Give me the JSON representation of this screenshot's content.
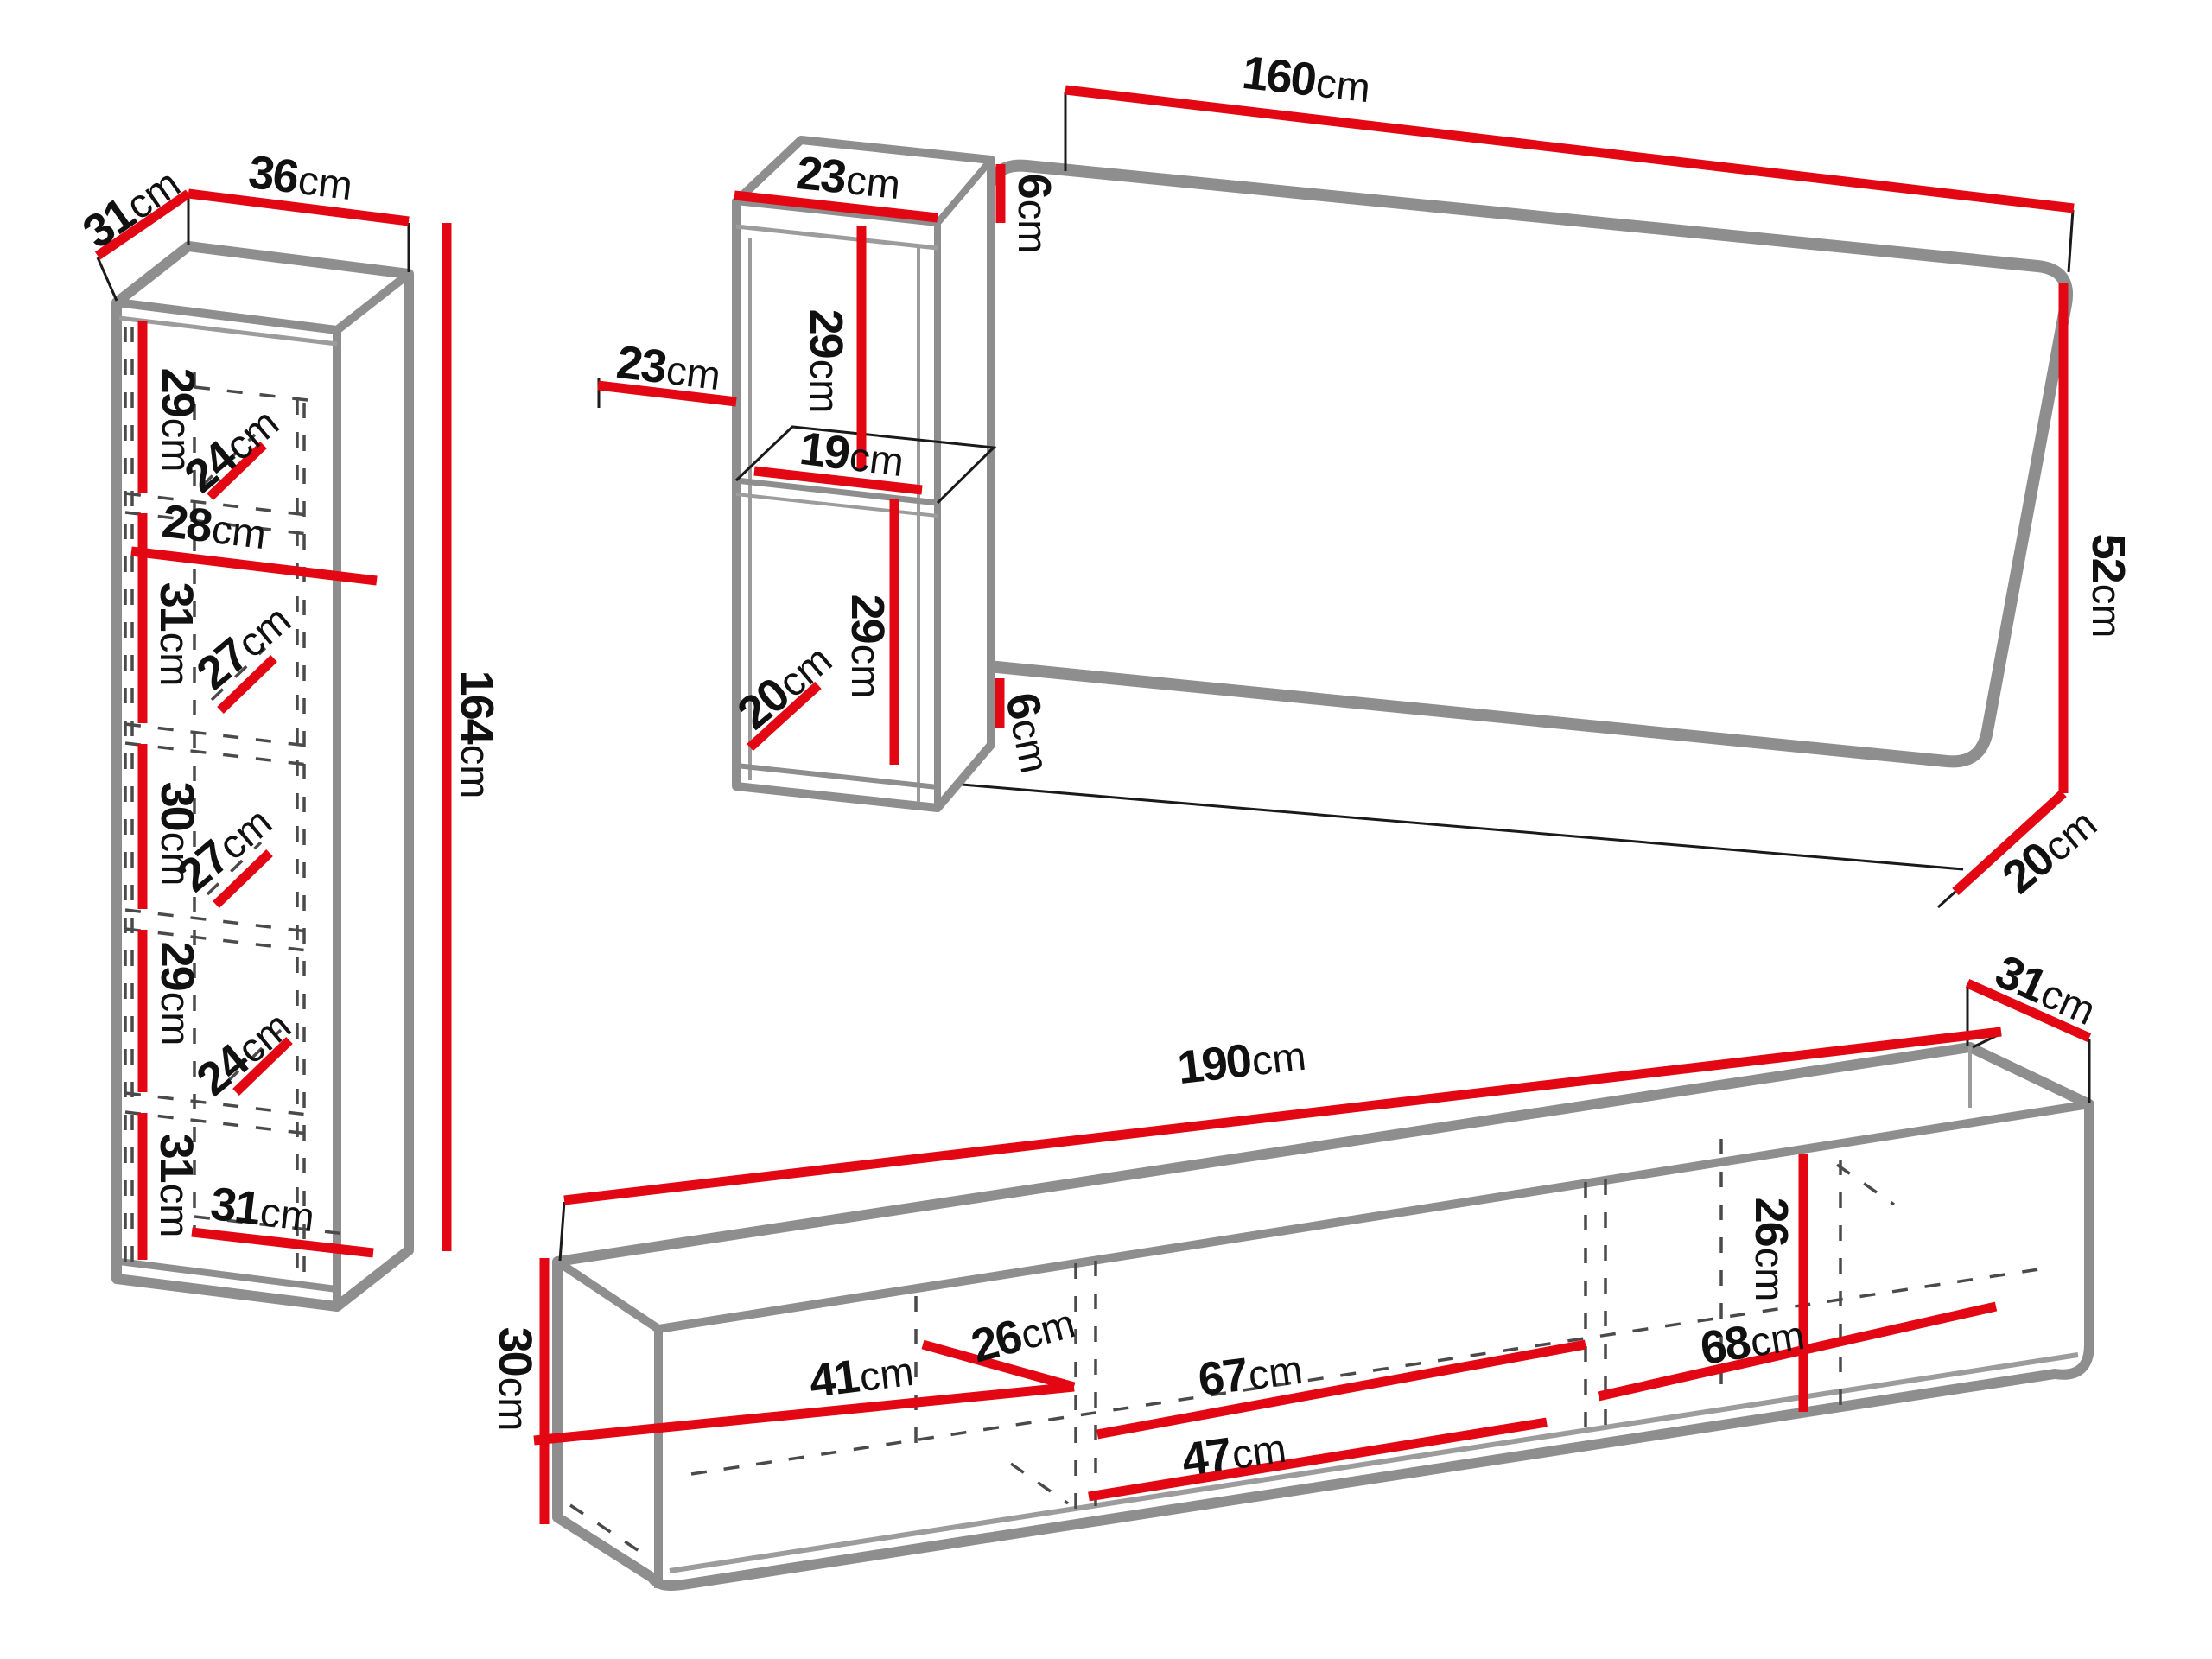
{
  "unit": "cm",
  "colors": {
    "dimension_line": "#e30613",
    "furniture_outline": "#8e8e8e",
    "label_text": "#111111",
    "background": "#ffffff"
  },
  "pieces": {
    "tall_cabinet": {
      "title": "tall storage cabinet",
      "dims": [
        {
          "id": "depth-top",
          "v": "31"
        },
        {
          "id": "width-top",
          "v": "36"
        },
        {
          "id": "height",
          "v": "164"
        },
        {
          "id": "compartment-1-height",
          "v": "29"
        },
        {
          "id": "compartment-1-depth",
          "v": "24"
        },
        {
          "id": "interior-width",
          "v": "28"
        },
        {
          "id": "compartment-2-height",
          "v": "31"
        },
        {
          "id": "compartment-2-depth",
          "v": "27"
        },
        {
          "id": "compartment-3-height",
          "v": "30"
        },
        {
          "id": "compartment-3-depth",
          "v": "27"
        },
        {
          "id": "compartment-4-height",
          "v": "29"
        },
        {
          "id": "compartment-4-depth",
          "v": "24"
        },
        {
          "id": "compartment-5-height",
          "v": "31"
        },
        {
          "id": "interior-bottom-width",
          "v": "31"
        }
      ]
    },
    "wall_shelf": {
      "title": "wall shelf unit",
      "dims": [
        {
          "id": "top-width",
          "v": "23"
        },
        {
          "id": "top-offset",
          "v": "6"
        },
        {
          "id": "depth",
          "v": "23"
        },
        {
          "id": "upper-compartment-height",
          "v": "29"
        },
        {
          "id": "shelf-width",
          "v": "19"
        },
        {
          "id": "lower-compartment-height",
          "v": "29"
        },
        {
          "id": "bottom-depth",
          "v": "20"
        },
        {
          "id": "bottom-offset",
          "v": "6"
        }
      ]
    },
    "wall_panel": {
      "title": "wall back panel",
      "dims": [
        {
          "id": "width",
          "v": "160"
        },
        {
          "id": "height",
          "v": "52"
        },
        {
          "id": "bottom-depth",
          "v": "20"
        }
      ]
    },
    "tv_stand": {
      "title": "tv stand",
      "dims": [
        {
          "id": "width",
          "v": "190"
        },
        {
          "id": "depth",
          "v": "31"
        },
        {
          "id": "height",
          "v": "30"
        },
        {
          "id": "compartment-1-width",
          "v": "41"
        },
        {
          "id": "interior-depth",
          "v": "26"
        },
        {
          "id": "compartment-2-width",
          "v": "67"
        },
        {
          "id": "drawer-width",
          "v": "47"
        },
        {
          "id": "compartment-3-width",
          "v": "68"
        },
        {
          "id": "interior-height",
          "v": "26"
        }
      ]
    }
  }
}
